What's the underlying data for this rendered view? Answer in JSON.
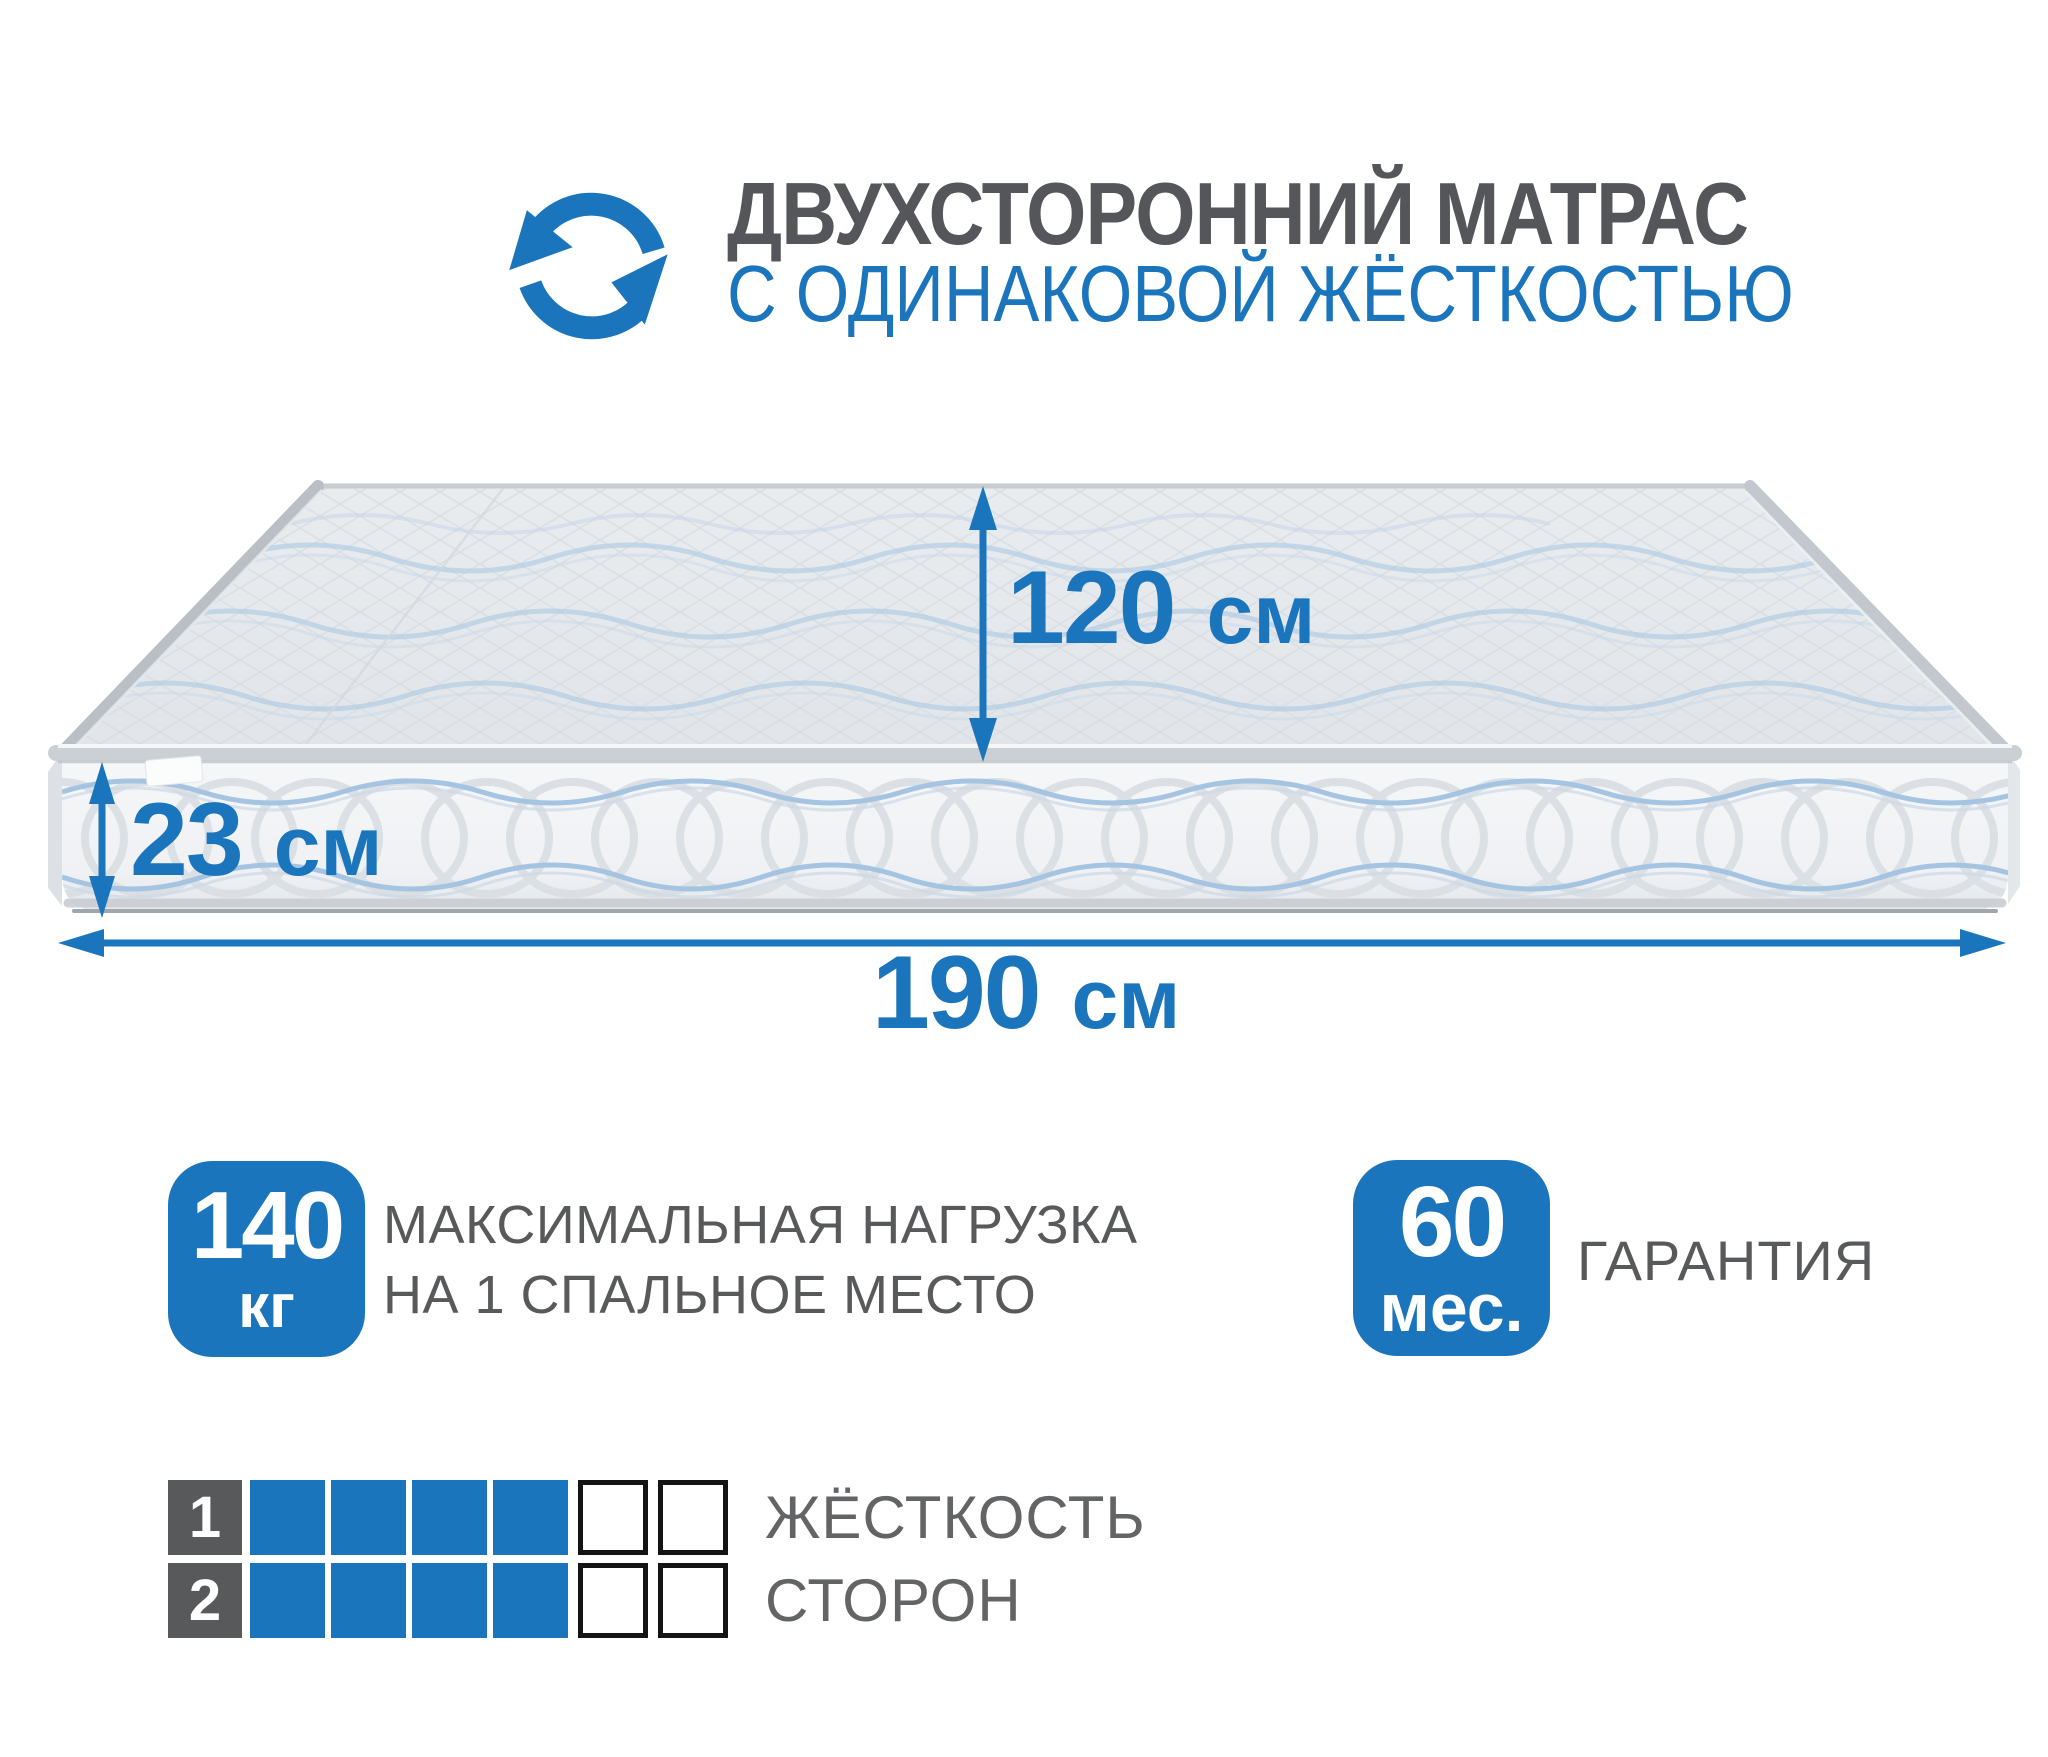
{
  "colors": {
    "accent_blue": "#1b75bc",
    "text_gray": "#58595b",
    "firmness_border": "#141414"
  },
  "icons": {
    "header": "rotate-arrows",
    "width_dimension": "double-headed-arrow-vertical",
    "height_dimension": "double-headed-arrow-vertical",
    "length_dimension": "double-headed-arrow-horizontal"
  },
  "header": {
    "title": "ДВУХСТОРОННИЙ МАТРАС",
    "subtitle": "С ОДИНАКОВОЙ ЖЁСТКОСТЬЮ"
  },
  "mattress_dimensions": {
    "width": {
      "value": "120",
      "unit": "см"
    },
    "height": {
      "value": "23",
      "unit": "см"
    },
    "length": {
      "value": "190",
      "unit": "см"
    }
  },
  "badges": {
    "max_load": {
      "value": "140",
      "unit": "кг",
      "label_line1": "МАКСИМАЛЬНАЯ НАГРУЗКА",
      "label_line2": "НА 1 СПАЛЬНОЕ МЕСТО"
    },
    "warranty": {
      "value": "60",
      "unit": "мес.",
      "label": "ГАРАНТИЯ"
    }
  },
  "firmness": {
    "label_line1": "ЖЁСТКОСТЬ",
    "label_line2": "СТОРОН",
    "scale_total": 6,
    "rows": [
      {
        "side": "1",
        "filled": 4,
        "empty": 2
      },
      {
        "side": "2",
        "filled": 4,
        "empty": 2
      }
    ]
  }
}
